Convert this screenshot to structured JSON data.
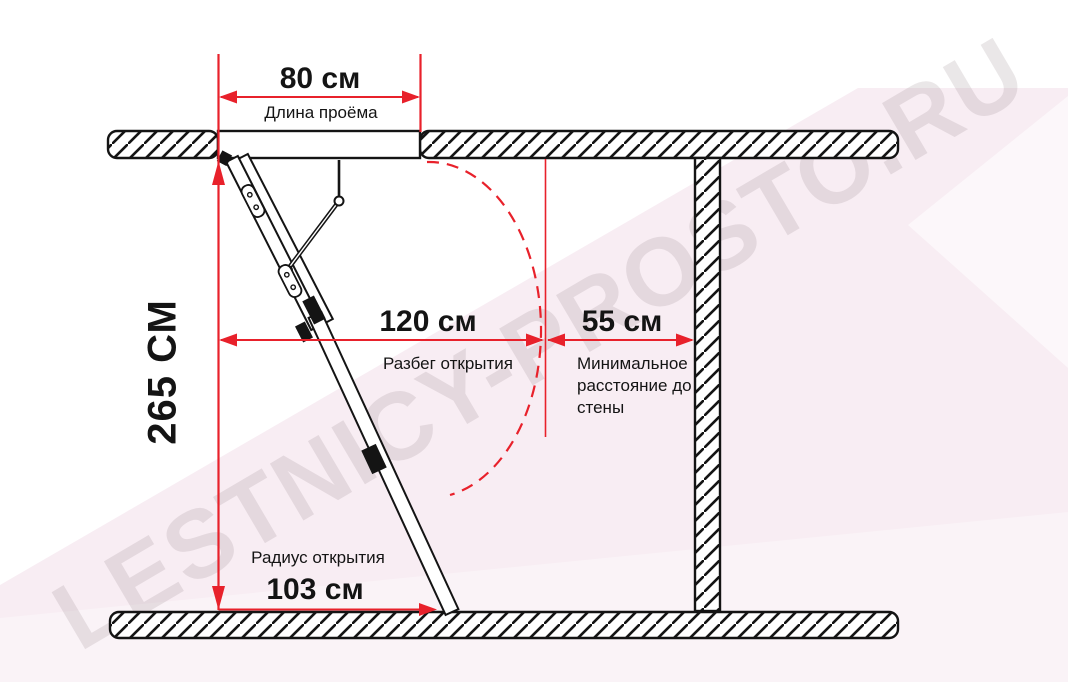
{
  "watermark": "LESTNICY-PROSTO.RU",
  "colors": {
    "dimension_red": "#e8212b",
    "ink": "#141414",
    "background_pink": "#f8edf3"
  },
  "dimensions": {
    "opening_length": {
      "value": "80 см",
      "label": "Длина проёма"
    },
    "ceiling_height": {
      "value": "265 СМ"
    },
    "opening_run": {
      "value": "120 см",
      "label": "Разбег открытия"
    },
    "wall_clearance": {
      "value": "55 см",
      "label": "Минимальное расстояние до стены"
    },
    "opening_radius": {
      "value": "103 см",
      "label": "Радиус открытия"
    }
  }
}
